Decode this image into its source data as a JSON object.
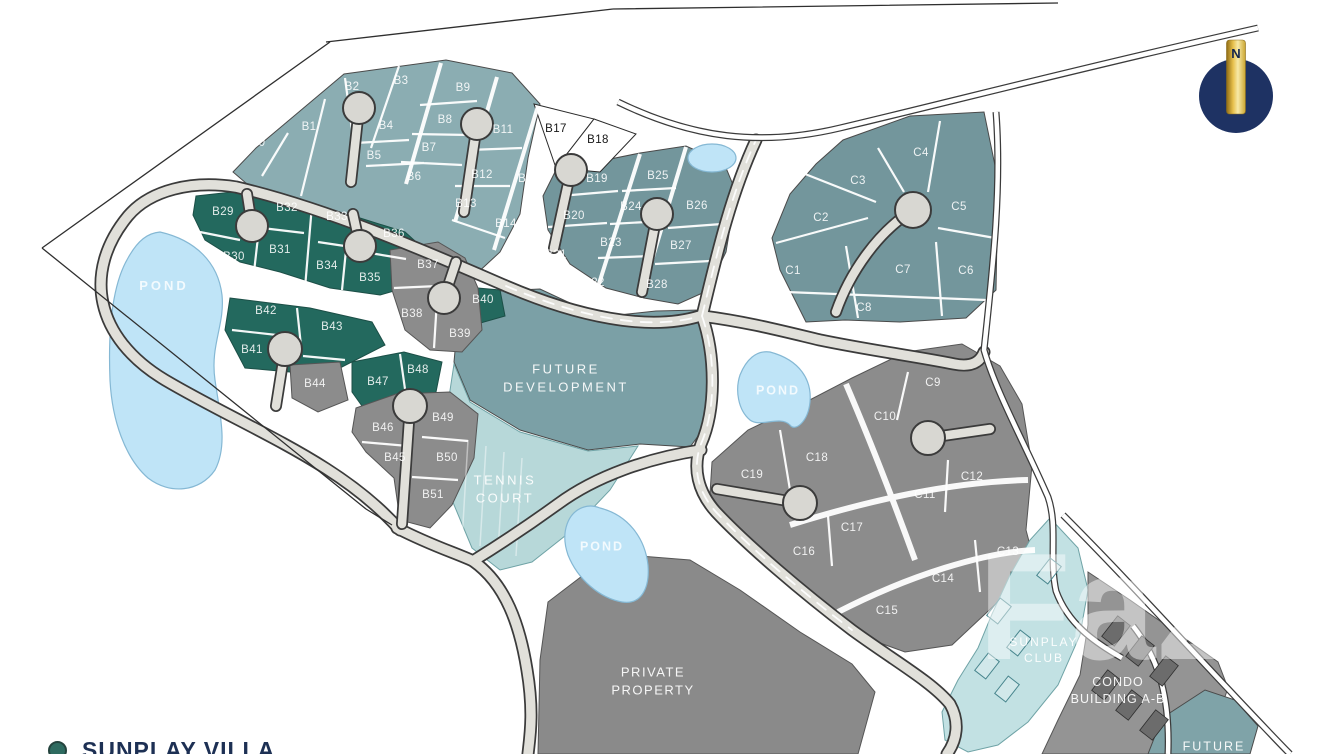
{
  "legend": {
    "label": "SUNPLAY VILLA"
  },
  "compass": {
    "label": "N"
  },
  "watermark": {
    "text": "FazWaz"
  },
  "colors": {
    "lot_teal_light": "#8badb2",
    "lot_teal_mid": "#73969c",
    "lot_green": "#23695e",
    "lot_gray": "#8c8c8c",
    "lot_white": "#ffffff",
    "future_dev": "#7ba0a6",
    "tennis": "#b7d8d9",
    "pond": "#bfe4f7",
    "pond_edge": "#85b8d4",
    "road_fill": "#e1e0da",
    "road_edge": "#3b3b3b",
    "white_road": "#ffffff",
    "private": "#8a8a8a",
    "club": "#c2e1e3",
    "condo": "#949494",
    "future_corner": "#7fa3a8",
    "compass_navy": "#1e3263",
    "compass_gold": "#e8c14d",
    "legend_navy": "#1d3054",
    "legend_green": "#2e6b60",
    "boundary": "#2f2f2f"
  },
  "lots": [
    {
      "id": "B0",
      "x": 258,
      "y": 143
    },
    {
      "id": "B1",
      "x": 309,
      "y": 127
    },
    {
      "id": "B2",
      "x": 352,
      "y": 87
    },
    {
      "id": "B3",
      "x": 401,
      "y": 81
    },
    {
      "id": "B4",
      "x": 386,
      "y": 126
    },
    {
      "id": "B5",
      "x": 374,
      "y": 156
    },
    {
      "id": "B6",
      "x": 414,
      "y": 177
    },
    {
      "id": "B7",
      "x": 429,
      "y": 148
    },
    {
      "id": "B8",
      "x": 445,
      "y": 120
    },
    {
      "id": "B9",
      "x": 463,
      "y": 88
    },
    {
      "id": "B11",
      "x": 503,
      "y": 130
    },
    {
      "id": "B12",
      "x": 482,
      "y": 175
    },
    {
      "id": "B13",
      "x": 466,
      "y": 204
    },
    {
      "id": "B14",
      "x": 506,
      "y": 224
    },
    {
      "id": "B15",
      "x": 529,
      "y": 179
    },
    {
      "id": "B17",
      "x": 556,
      "y": 129,
      "dark": true
    },
    {
      "id": "B18",
      "x": 598,
      "y": 140,
      "dark": true
    },
    {
      "id": "B19",
      "x": 597,
      "y": 179
    },
    {
      "id": "B20",
      "x": 574,
      "y": 216
    },
    {
      "id": "B21",
      "x": 556,
      "y": 255
    },
    {
      "id": "B22",
      "x": 594,
      "y": 283
    },
    {
      "id": "B23",
      "x": 611,
      "y": 243
    },
    {
      "id": "B24",
      "x": 631,
      "y": 207
    },
    {
      "id": "B25",
      "x": 658,
      "y": 176
    },
    {
      "id": "B26",
      "x": 697,
      "y": 206
    },
    {
      "id": "B27",
      "x": 681,
      "y": 246
    },
    {
      "id": "B28",
      "x": 657,
      "y": 285
    },
    {
      "id": "B29",
      "x": 223,
      "y": 212
    },
    {
      "id": "B30",
      "x": 234,
      "y": 257
    },
    {
      "id": "B31",
      "x": 280,
      "y": 250
    },
    {
      "id": "B32",
      "x": 287,
      "y": 208
    },
    {
      "id": "B33",
      "x": 337,
      "y": 217
    },
    {
      "id": "B34",
      "x": 327,
      "y": 266
    },
    {
      "id": "B35",
      "x": 370,
      "y": 278
    },
    {
      "id": "B36",
      "x": 394,
      "y": 234
    },
    {
      "id": "B37",
      "x": 428,
      "y": 265
    },
    {
      "id": "B38",
      "x": 412,
      "y": 314
    },
    {
      "id": "B39",
      "x": 460,
      "y": 334
    },
    {
      "id": "B40",
      "x": 483,
      "y": 300
    },
    {
      "id": "B41",
      "x": 252,
      "y": 350
    },
    {
      "id": "B42",
      "x": 266,
      "y": 311
    },
    {
      "id": "B43",
      "x": 332,
      "y": 327
    },
    {
      "id": "B44",
      "x": 315,
      "y": 384
    },
    {
      "id": "B45",
      "x": 395,
      "y": 458
    },
    {
      "id": "B46",
      "x": 383,
      "y": 428
    },
    {
      "id": "B47",
      "x": 378,
      "y": 382
    },
    {
      "id": "B48",
      "x": 418,
      "y": 370
    },
    {
      "id": "B49",
      "x": 443,
      "y": 418
    },
    {
      "id": "B50",
      "x": 447,
      "y": 458
    },
    {
      "id": "B51",
      "x": 433,
      "y": 495
    },
    {
      "id": "C1",
      "x": 793,
      "y": 271
    },
    {
      "id": "C2",
      "x": 821,
      "y": 218
    },
    {
      "id": "C3",
      "x": 858,
      "y": 181
    },
    {
      "id": "C4",
      "x": 921,
      "y": 153
    },
    {
      "id": "C5",
      "x": 959,
      "y": 207
    },
    {
      "id": "C6",
      "x": 966,
      "y": 271
    },
    {
      "id": "C7",
      "x": 903,
      "y": 270
    },
    {
      "id": "C8",
      "x": 864,
      "y": 308
    },
    {
      "id": "C9",
      "x": 933,
      "y": 383
    },
    {
      "id": "C10",
      "x": 885,
      "y": 417
    },
    {
      "id": "C11",
      "x": 925,
      "y": 495
    },
    {
      "id": "C12",
      "x": 972,
      "y": 477
    },
    {
      "id": "C13",
      "x": 1008,
      "y": 552
    },
    {
      "id": "C14",
      "x": 943,
      "y": 579
    },
    {
      "id": "C15",
      "x": 887,
      "y": 611
    },
    {
      "id": "C16",
      "x": 804,
      "y": 552
    },
    {
      "id": "C17",
      "x": 852,
      "y": 528
    },
    {
      "id": "C18",
      "x": 817,
      "y": 458
    },
    {
      "id": "C19",
      "x": 752,
      "y": 475
    }
  ],
  "areas": [
    {
      "id": "future-development",
      "lines": [
        "FUTURE",
        "DEVELOPMENT"
      ],
      "x": 566,
      "y": 378,
      "size": 13,
      "ls": 2.5
    },
    {
      "id": "tennis-court",
      "lines": [
        "TENNIS",
        "COURT"
      ],
      "x": 505,
      "y": 489,
      "size": 13,
      "ls": 2.5
    },
    {
      "id": "private-property",
      "lines": [
        "PRIVATE",
        "PROPERTY"
      ],
      "x": 653,
      "y": 681,
      "size": 13,
      "ls": 1.5
    },
    {
      "id": "sunplay-club",
      "lines": [
        "SUNPLAY",
        "CLUB"
      ],
      "x": 1044,
      "y": 650,
      "size": 12,
      "ls": 2
    },
    {
      "id": "condo-building-a-b",
      "lines": [
        "CONDO",
        "BUILDING A-B"
      ],
      "x": 1118,
      "y": 691,
      "size": 12.5,
      "ls": 1
    },
    {
      "id": "future-corner",
      "lines": [
        "FUTURE"
      ],
      "x": 1214,
      "y": 747,
      "size": 12.5,
      "ls": 2
    },
    {
      "id": "pond-west",
      "lines": [
        "POND"
      ],
      "x": 164,
      "y": 286,
      "size": 13,
      "ls": 3,
      "cls": "pond"
    },
    {
      "id": "pond-east",
      "lines": [
        "POND"
      ],
      "x": 778,
      "y": 391,
      "size": 12.5,
      "ls": 2,
      "cls": "pond"
    },
    {
      "id": "pond-south",
      "lines": [
        "POND"
      ],
      "x": 602,
      "y": 547,
      "size": 12.5,
      "ls": 2,
      "cls": "pond"
    }
  ]
}
